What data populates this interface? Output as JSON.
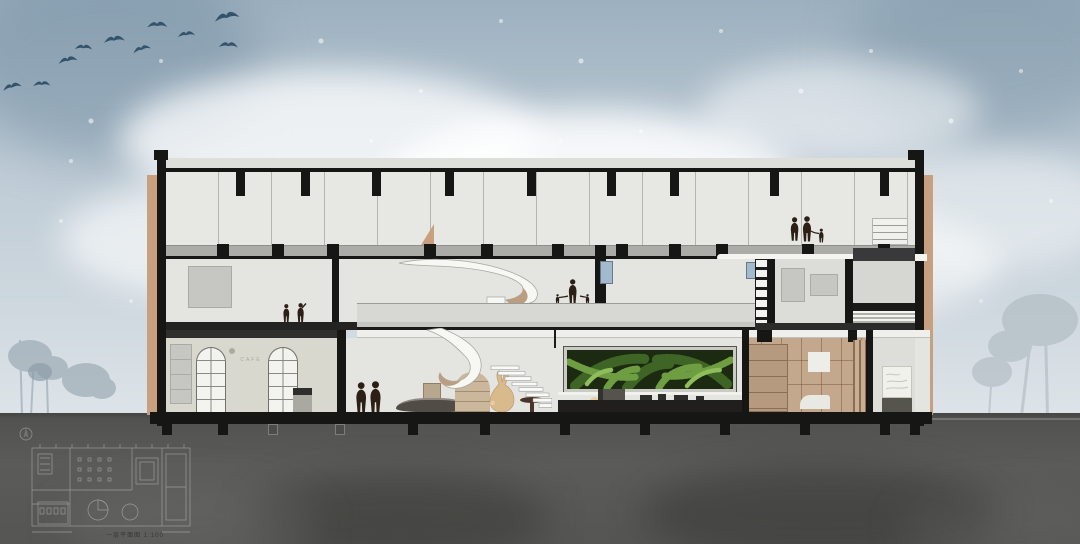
{
  "meta": {
    "description": "Watercolor architectural cross-section illustration: three-storey building with spiral staircase, fern feature wall, rabbit sculpture and silhouetted figures; flock of birds in the sky; faint first-floor plan drawn on the ground at lower left."
  },
  "plan_inset": {
    "caption": "一层平面图 1:100"
  },
  "storefront": {
    "sign_text": "CAFE"
  },
  "counts": {
    "birds": 10,
    "floors_visible": 3
  },
  "colors": {
    "sky_top": "#9cb0bf",
    "sky_mid": "#bfccd6",
    "sky_low": "#dfe5e9",
    "cloud": "#f6f8f9",
    "bird": "#34536a",
    "tree_left": "#8c9da8",
    "tree_right": "#a9b5bc",
    "ground": "#565654",
    "structure_black": "#161614",
    "slab_grey": "#ababa7",
    "interior": "#e7e8e4",
    "wood_cladding": "#c89f7f",
    "wood_interior": "#c4a88d",
    "storefront_wall": "#d8d8ce",
    "green_wall_bg": "#1d2a12",
    "fern_dark": "#3e6526",
    "fern_mid": "#6f9e42",
    "fern_light": "#8fbd5c",
    "rabbit": "#d9ba8c",
    "people": "#2c1f16",
    "window_blue": "#a3b9ce",
    "plan_line": "#ffffff"
  }
}
